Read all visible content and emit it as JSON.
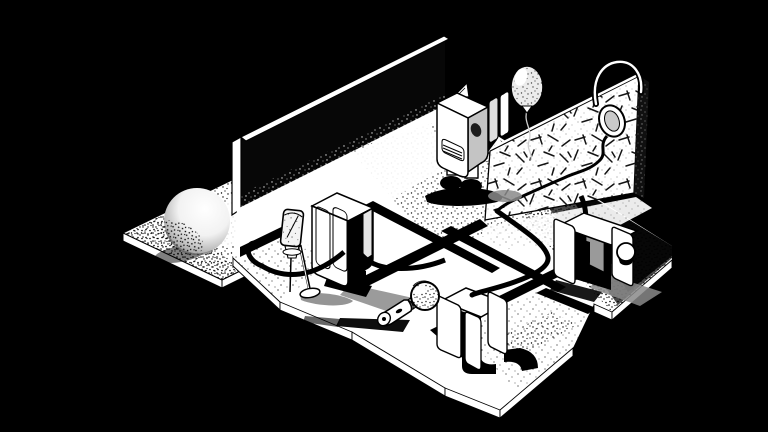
{
  "scene": {
    "description": "Black-and-white stippled isometric illustration: a dark stage built of floating floor slabs. Five cabinet-speaker robots with open doors stand on the slabs. A tall blank wall rises at the back left, a hatched acoustic panel wall stands at the right with headphones hung over its top edge, a balloon floats above, a studio microphone balances on a needle-point stand, a handheld microphone lies on the floor, a sphere rests on a separate platform, and thick audio cables snake between the robots.",
    "style": "stippled black-and-white ink illustration, isometric view",
    "background_label": "black void"
  },
  "palette": {
    "background": "#000000",
    "ink": "#000000",
    "paper": "#ffffff",
    "soft_shadow": "#8a8a8a",
    "panel_gray": "#c4c4c4",
    "inner_gray": "#9a9a9a"
  },
  "elements": {
    "sphere_platform": {
      "label": "stippled platform with sphere",
      "x": 210,
      "y": 225
    },
    "sphere": {
      "label": "shaded sphere",
      "x": 197,
      "y": 221
    },
    "tall_wall": {
      "label": "tall blank wall seen edge-on",
      "x": 340,
      "y": 120
    },
    "acoustic_wall": {
      "label": "hatched acoustic panel wall",
      "x": 560,
      "y": 148
    },
    "headphones": {
      "label": "headphones hung over wall edge",
      "x": 615,
      "y": 100
    },
    "balloon": {
      "label": "balloon on string",
      "x": 527,
      "y": 87
    },
    "robot_top": {
      "label": "speaker-cabinet robot with grille and open side doors",
      "x": 462,
      "y": 140
    },
    "robot_center": {
      "label": "tall cabinet robot with open side",
      "x": 342,
      "y": 240
    },
    "robot_front": {
      "label": "open-door cabinet robot",
      "x": 472,
      "y": 330
    },
    "robot_right": {
      "label": "open-door cabinet robot with ball hand",
      "x": 595,
      "y": 255
    },
    "mic_stand": {
      "label": "studio microphone on needle stand",
      "x": 296,
      "y": 250
    },
    "handheld_mic": {
      "label": "handheld microphone lying on floor",
      "x": 405,
      "y": 308
    },
    "floor": {
      "label": "isometric floor slabs with black gaps",
      "slab_count": 6
    },
    "cables": {
      "label": "thick black audio cables",
      "count": 3
    }
  }
}
